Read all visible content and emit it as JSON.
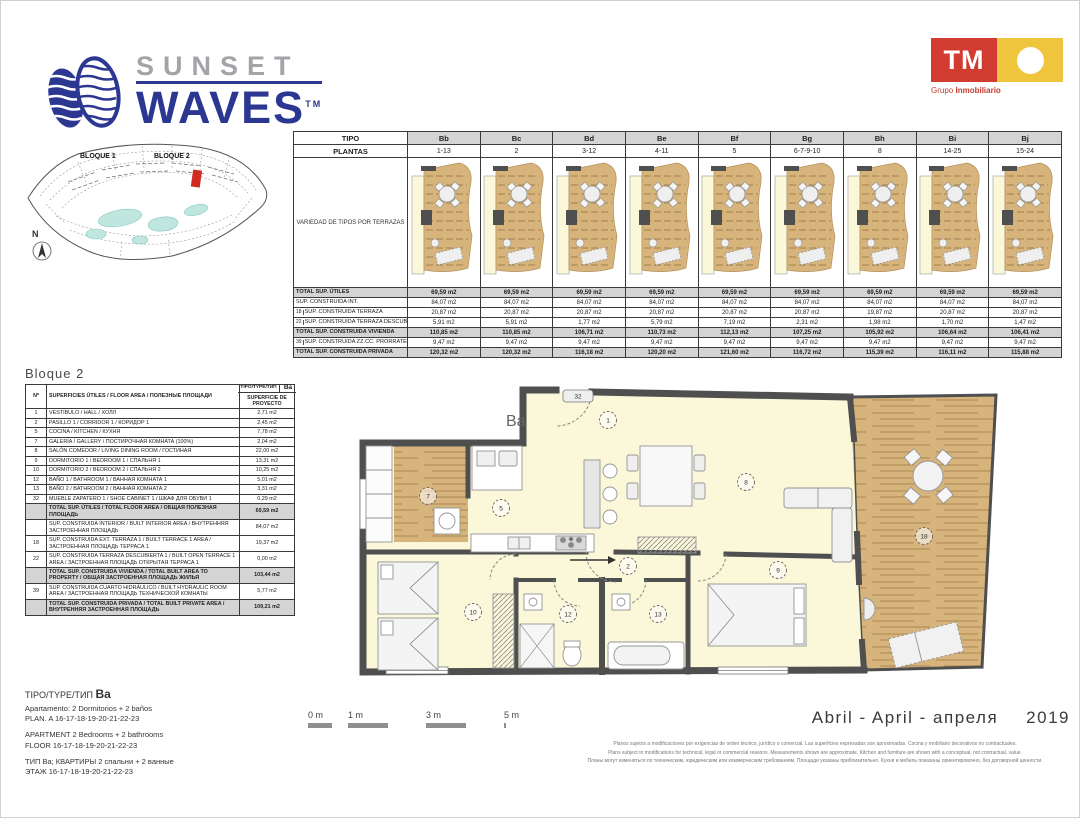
{
  "brand": {
    "name_top": "SUNSET",
    "name_bottom": "WAVES",
    "tm": "TM",
    "navy": "#2c3792",
    "gray": "#a2a4a8"
  },
  "developer": {
    "logo_text": "TM",
    "tagline_regular": "Grupo ",
    "tagline_bold": "Inmobiliario",
    "red": "#d23b2f",
    "yellow": "#eec53d"
  },
  "siteplan": {
    "bloque1": "BLOQUE 1",
    "bloque2": "BLOQUE 2",
    "north": "N",
    "pool_color": "#bfe6df",
    "highlight_color": "#cf2b20"
  },
  "types_table": {
    "header_row_label": "TIPO",
    "plantas_row_label": "PLANTAS",
    "variety_label": "VARIEDAD DE TIPOS POR TERRAZAS",
    "columns": [
      {
        "tipo": "Bb",
        "plantas": "1-13"
      },
      {
        "tipo": "Bc",
        "plantas": "2"
      },
      {
        "tipo": "Bd",
        "plantas": "3-12"
      },
      {
        "tipo": "Be",
        "plantas": "4-11"
      },
      {
        "tipo": "Bf",
        "plantas": "5"
      },
      {
        "tipo": "Bg",
        "plantas": "6-7-9-10"
      },
      {
        "tipo": "Bh",
        "plantas": "8"
      },
      {
        "tipo": "Bi",
        "plantas": "14-25"
      },
      {
        "tipo": "Bj",
        "plantas": "15-24"
      }
    ],
    "rows": [
      {
        "num": "",
        "label": "TOTAL SUP. ÚTILES",
        "shaded": true,
        "values": [
          "69,59 m2",
          "69,59 m2",
          "69,59 m2",
          "69,59 m2",
          "69,59 m2",
          "69,59 m2",
          "69,59 m2",
          "69,59 m2",
          "69,59 m2"
        ]
      },
      {
        "num": "",
        "label": "SUP. CONSTRUIDA INT.",
        "shaded": false,
        "values": [
          "84,07 m2",
          "84,07 m2",
          "84,07 m2",
          "84,07 m2",
          "84,07 m2",
          "84,07 m2",
          "84,07 m2",
          "84,07 m2",
          "84,07 m2"
        ]
      },
      {
        "num": "18",
        "label": "SUP. CONSTRUIDA TERRAZA",
        "shaded": false,
        "values": [
          "20,87 m2",
          "20,87 m2",
          "20,87 m2",
          "20,87 m2",
          "20,87 m2",
          "20,87 m2",
          "19,87 m2",
          "20,87 m2",
          "20,87 m2"
        ]
      },
      {
        "num": "22",
        "label": "SUP. CONSTRUIDA TERRAZA DESCUBIERTA",
        "shaded": false,
        "values": [
          "5,91 m2",
          "5,91 m2",
          "1,77 m2",
          "5,79 m2",
          "7,19 m2",
          "2,31 m2",
          "1,98 m2",
          "1,70 m2",
          "1,47 m2"
        ]
      },
      {
        "num": "",
        "label": "TOTAL SUP. CONSTRUIDA VIVIENDA",
        "shaded": true,
        "values": [
          "110,85 m2",
          "110,85 m2",
          "106,71 m2",
          "110,73 m2",
          "112,13 m2",
          "107,25 m2",
          "105,92 m2",
          "106,64 m2",
          "106,41 m2"
        ]
      },
      {
        "num": "39",
        "label": "SUP. CONSTRUIDA ZZ.CC. PRORRATEO",
        "shaded": false,
        "values": [
          "9,47 m2",
          "9,47 m2",
          "9,47 m2",
          "9,47 m2",
          "9,47 m2",
          "9,47 m2",
          "9,47 m2",
          "9,47 m2",
          "9,47 m2"
        ]
      },
      {
        "num": "",
        "label": "TOTAL SUP. CONSTRUIDA PRIVADA",
        "shaded": true,
        "values": [
          "120,32 m2",
          "120,32 m2",
          "116,18 m2",
          "120,20 m2",
          "121,60 m2",
          "116,72 m2",
          "115,39 m2",
          "116,11 m2",
          "115,88 m2"
        ]
      }
    ]
  },
  "unit_table": {
    "title": "Bloque 2",
    "header": {
      "num": "Nº",
      "surfaces": "SUPERFICIES ÚTILES / FLOOR AREA / ПОЛЕЗНЫЕ ПЛОЩАДИ",
      "tipo": "TIPO/TYPE/ТИП",
      "type_code": "Ba",
      "superficie": "SUPERFICIE DE PROYECTO"
    },
    "rows": [
      {
        "num": "1",
        "label": "VESTÍBULO / HALL / ХОЛЛ",
        "value": "2,71 m2"
      },
      {
        "num": "2",
        "label": "PASILLO 1 / CORRIDOR 1 / КОРИДОР 1",
        "value": "2,45 m2"
      },
      {
        "num": "5",
        "label": "COCINA / KITCHEN / КУХНЯ",
        "value": "7,78 m2"
      },
      {
        "num": "7",
        "label": "GALERÍA / GALLERY / ПОСТИРОЧНАЯ КОМНАТА (100%)",
        "value": "2,04 m2"
      },
      {
        "num": "8",
        "label": "SALÓN COMEDOR / LIVING DINING ROOM / ГОСТИНАЯ",
        "value": "22,00 m2"
      },
      {
        "num": "9",
        "label": "DORMITORIO 1 / BEDROOM 1 / СПАЛЬНЯ 1",
        "value": "13,31 m2"
      },
      {
        "num": "10",
        "label": "DORMITORIO 2 / BEDROOM 2 / СПАЛЬНЯ 2",
        "value": "10,25 m2"
      },
      {
        "num": "12",
        "label": "BAÑO 1 / BATHROOM 1 / ВАННАЯ КОМНАТА 1",
        "value": "5,01 m2"
      },
      {
        "num": "13",
        "label": "BAÑO 2 / BATHROOM 2 / ВАННАЯ КОМНАТА 2",
        "value": "3,31 m2"
      },
      {
        "num": "32",
        "label": "MUEBLE ZAPATERO 1 / SHOE CABINET 1 / ШКАФ ДЛЯ ОБУВИ 1",
        "value": "0,29 m2"
      }
    ],
    "summary": [
      {
        "num": "",
        "label": "TOTAL SUP. ÚTILES / TOTAL FLOOR AREA / ОБЩАЯ ПОЛЕЗНАЯ ПЛОЩАДЬ",
        "value": "69,59 m2",
        "shaded": true
      },
      {
        "num": "",
        "label": "SUP. CONSTRUIDA INTERIOR / BUILT INTERIOR AREA / ВНУТРЕННЯЯ ЗАСТРОЕННАЯ ПЛОЩАДЬ",
        "value": "84,07 m2",
        "shaded": false
      },
      {
        "num": "18",
        "label": "SUP. CONSTRUIDA EXT. TERRAZA 1 / BUILT TERRACE 1 AREA / ЗАСТРОЕННАЯ ПЛОЩАДЬ ТЕРРАСА 1",
        "value": "19,37 m2",
        "shaded": false
      },
      {
        "num": "22",
        "label": "SUP. CONSTRUIDA TERRAZA DESCUBIERTA 1 / BUILT OPEN TERRACE 1 AREA / ЗАСТРОЕННАЯ ПЛОЩАДЬ ОТКРЫТАЯ ТЕРРАСА 1",
        "value": "0,00 m2",
        "shaded": false
      },
      {
        "num": "",
        "label": "TOTAL SUP. CONSTRUIDA VIVIENDA / TOTAL BUILT AREA TO PROPERTY / ОБЩАЯ ЗАСТРОЕННАЯ ПЛОЩАДЬ ЖИЛЬЯ",
        "value": "103,44 m2",
        "shaded": true
      },
      {
        "num": "39",
        "label": "SUP. CONSTRUIDA CUARTO HIDRÁULICO / BUILT HYDRAULIC ROOM AREA / ЗАСТРОЕННАЯ ПЛОЩАДЬ ТЕХНИЧЕСКОЙ КОМНАТЫ",
        "value": "5,77 m2",
        "shaded": false
      },
      {
        "num": "",
        "label": "TOTAL SUP. CONSTRUIDA PRIVADA / TOTAL BUILT PRIVATE AREA / ВНУТРЕННЯЯ ЗАСТРОЕННАЯ ПЛОЩАДЬ",
        "value": "109,21 m2",
        "shaded": true
      }
    ]
  },
  "floorplan": {
    "label": "Ba",
    "rooms": [
      "1",
      "2",
      "5",
      "7",
      "8",
      "9",
      "10",
      "12",
      "13",
      "18",
      "32"
    ],
    "wall_color": "#4f4f4f",
    "floor_color": "#fbf7d9",
    "wood_color": "#d7b47c"
  },
  "type_info": {
    "head_prefix": "TIPO/TYPE/ТИП ",
    "head_code": "Ba",
    "es1": "Apartamento:  2  Dormitorios + 2 baños",
    "es2": "PLAN.  A 16-17-18-19-20-21-22-23",
    "en1": "APARTMENT 2 Bedrooms + 2 bathrooms",
    "en2": "FLOOR 16-17-18-19-20-21-22-23",
    "ru1": "ТИП Ba; КВАРТИРЫ 2 спальни + 2 ванные",
    "ru2": "ЭТАЖ 16-17-18-19-20-21-22-23"
  },
  "scalebar": {
    "labels": [
      "0 m",
      "1 m",
      "3 m",
      "5 m"
    ]
  },
  "footer": {
    "date_text": "Abril - April - апреля",
    "year": "2019",
    "disclaimer_es": "Planos sujetos a modificaciones por exigencias de orden técnico, jurídico o comercial. Las superficies expresadas son aproximadas. Cocina y mobiliario decorativos no contractuales.",
    "disclaimer_en": "Plans subject to modifications for technical, legal or commercial reasons. Measurements shown are approximate. Kitchen and furniture are shown with a conceptual, not contractual, value.",
    "disclaimer_ru": "Планы могут изменяться по техническим, юридическим или коммерческим требованиям. Площади указаны приблизительно. Кухня и мебель показаны ориентировочно, без договорной ценности."
  }
}
